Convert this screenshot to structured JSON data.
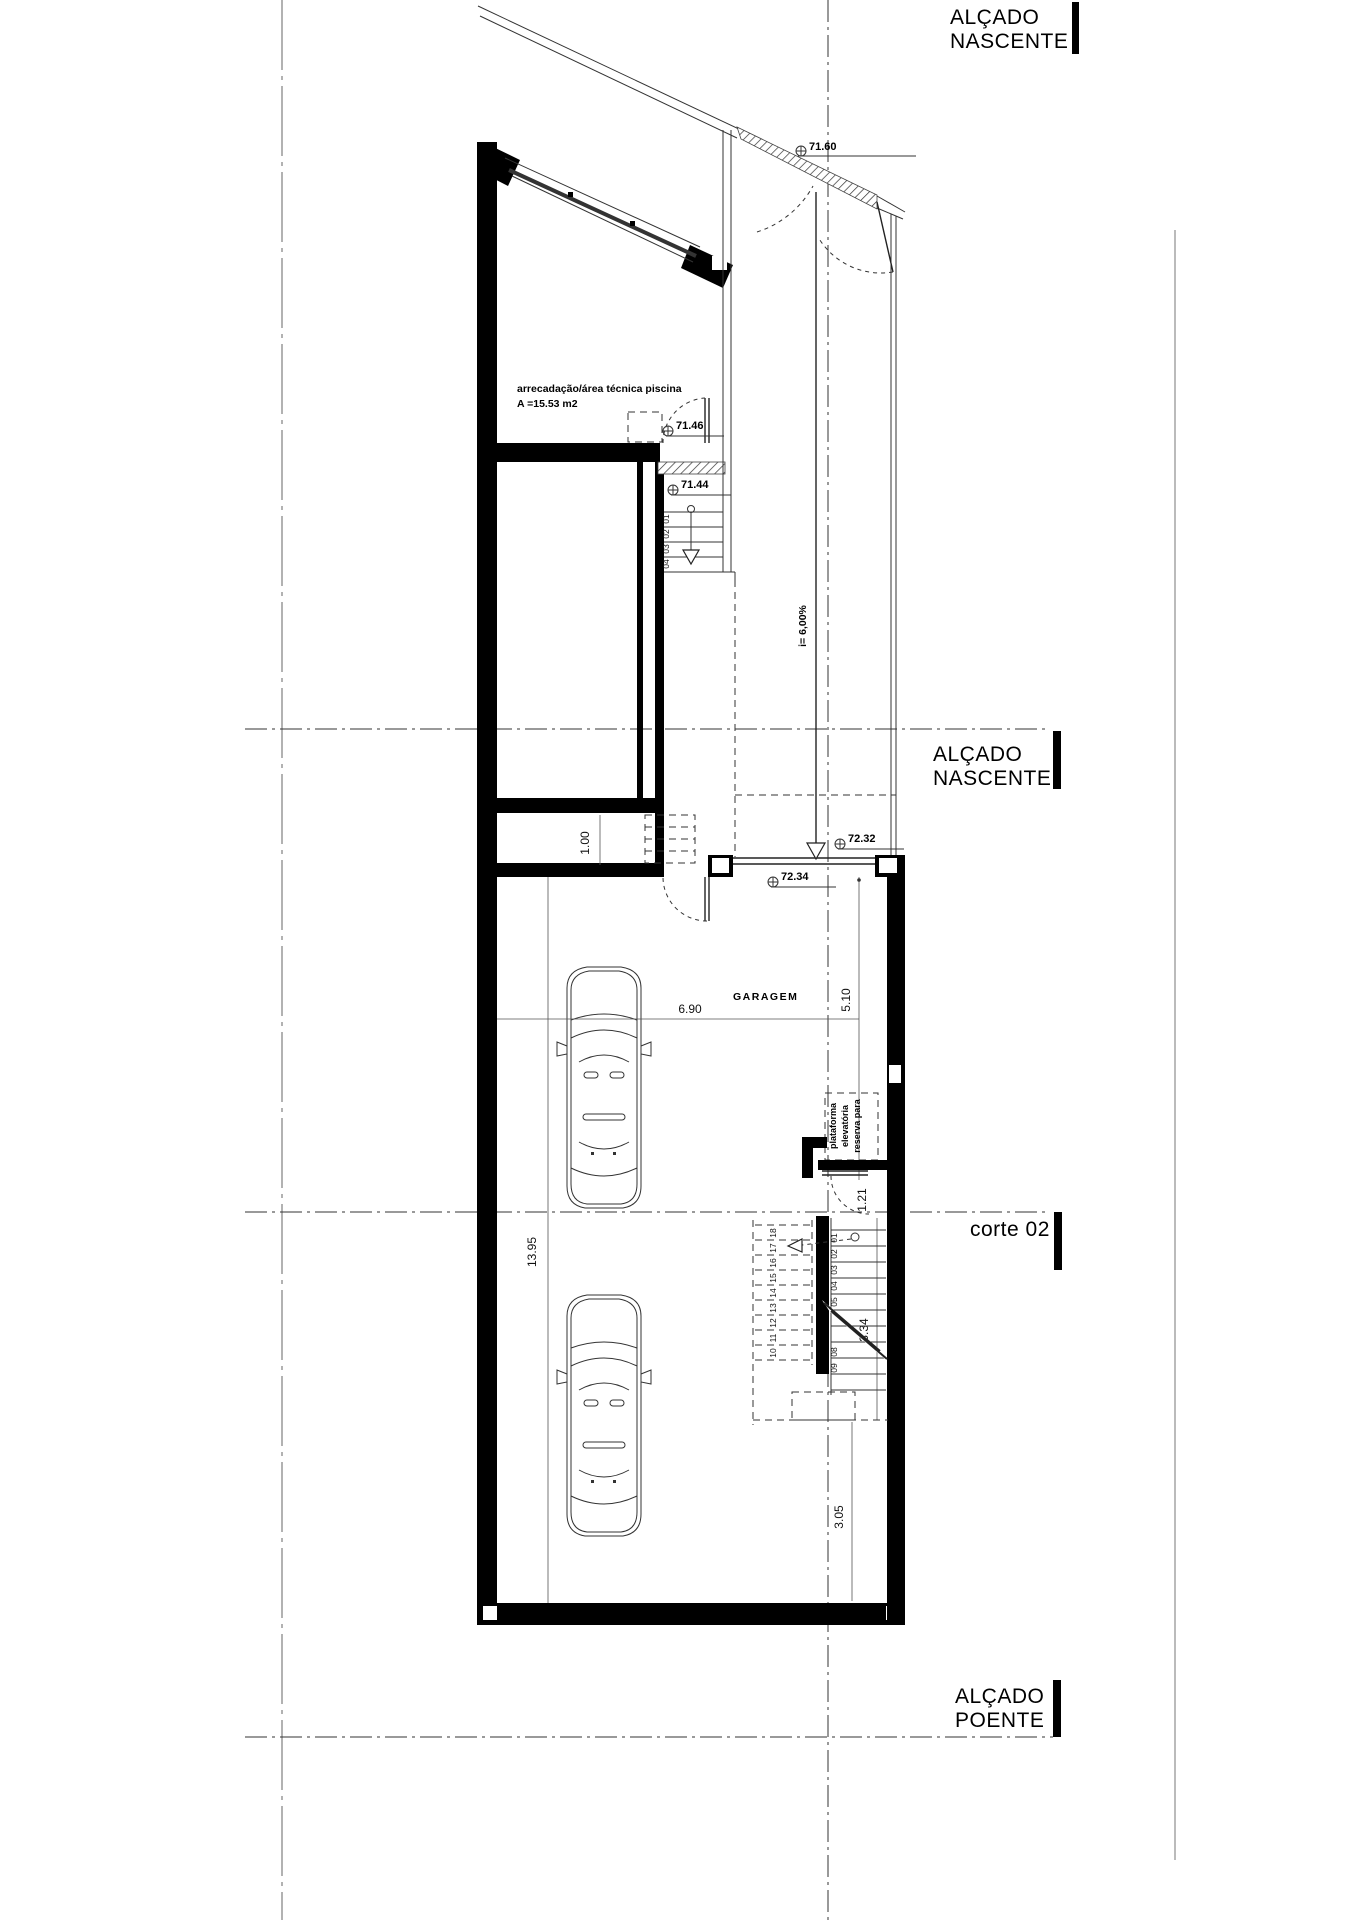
{
  "labels": {
    "top1": "ALÇADO",
    "top2": "NASCENTE",
    "mid1": "ALÇADO",
    "mid2": "NASCENTE",
    "corte": "corte 02",
    "bot1": "ALÇADO",
    "bot2": "POENTE"
  },
  "rooms": {
    "storage_l1": "arrecadação/área técnica piscina",
    "storage_l2": "A =15.53 m2",
    "garage": "GARAGEM"
  },
  "platform": {
    "l1": "plataforma",
    "l2": "elevatória",
    "l3": "reserva para"
  },
  "levels": {
    "top": "71.60",
    "upper_door": "71.46",
    "upper_stair": "71.44",
    "ramp_bottom": "72.32",
    "garage_entry": "72.34"
  },
  "ramp": {
    "slope": "i= 6,00%"
  },
  "dims": {
    "d690": "6.90",
    "d510": "5.10",
    "d1395": "13.95",
    "d100": "1.00",
    "d121": "1.21",
    "d334": "3.34",
    "d305": "3.05"
  },
  "stairs": {
    "upper": [
      "01",
      "02",
      "03",
      "04"
    ],
    "lower_solid": [
      "01",
      "02",
      "03",
      "04",
      "05",
      "08",
      "09"
    ],
    "lower_dashed": [
      "18",
      "17",
      "16",
      "15",
      "14",
      "13",
      "12",
      "11",
      "10"
    ]
  }
}
